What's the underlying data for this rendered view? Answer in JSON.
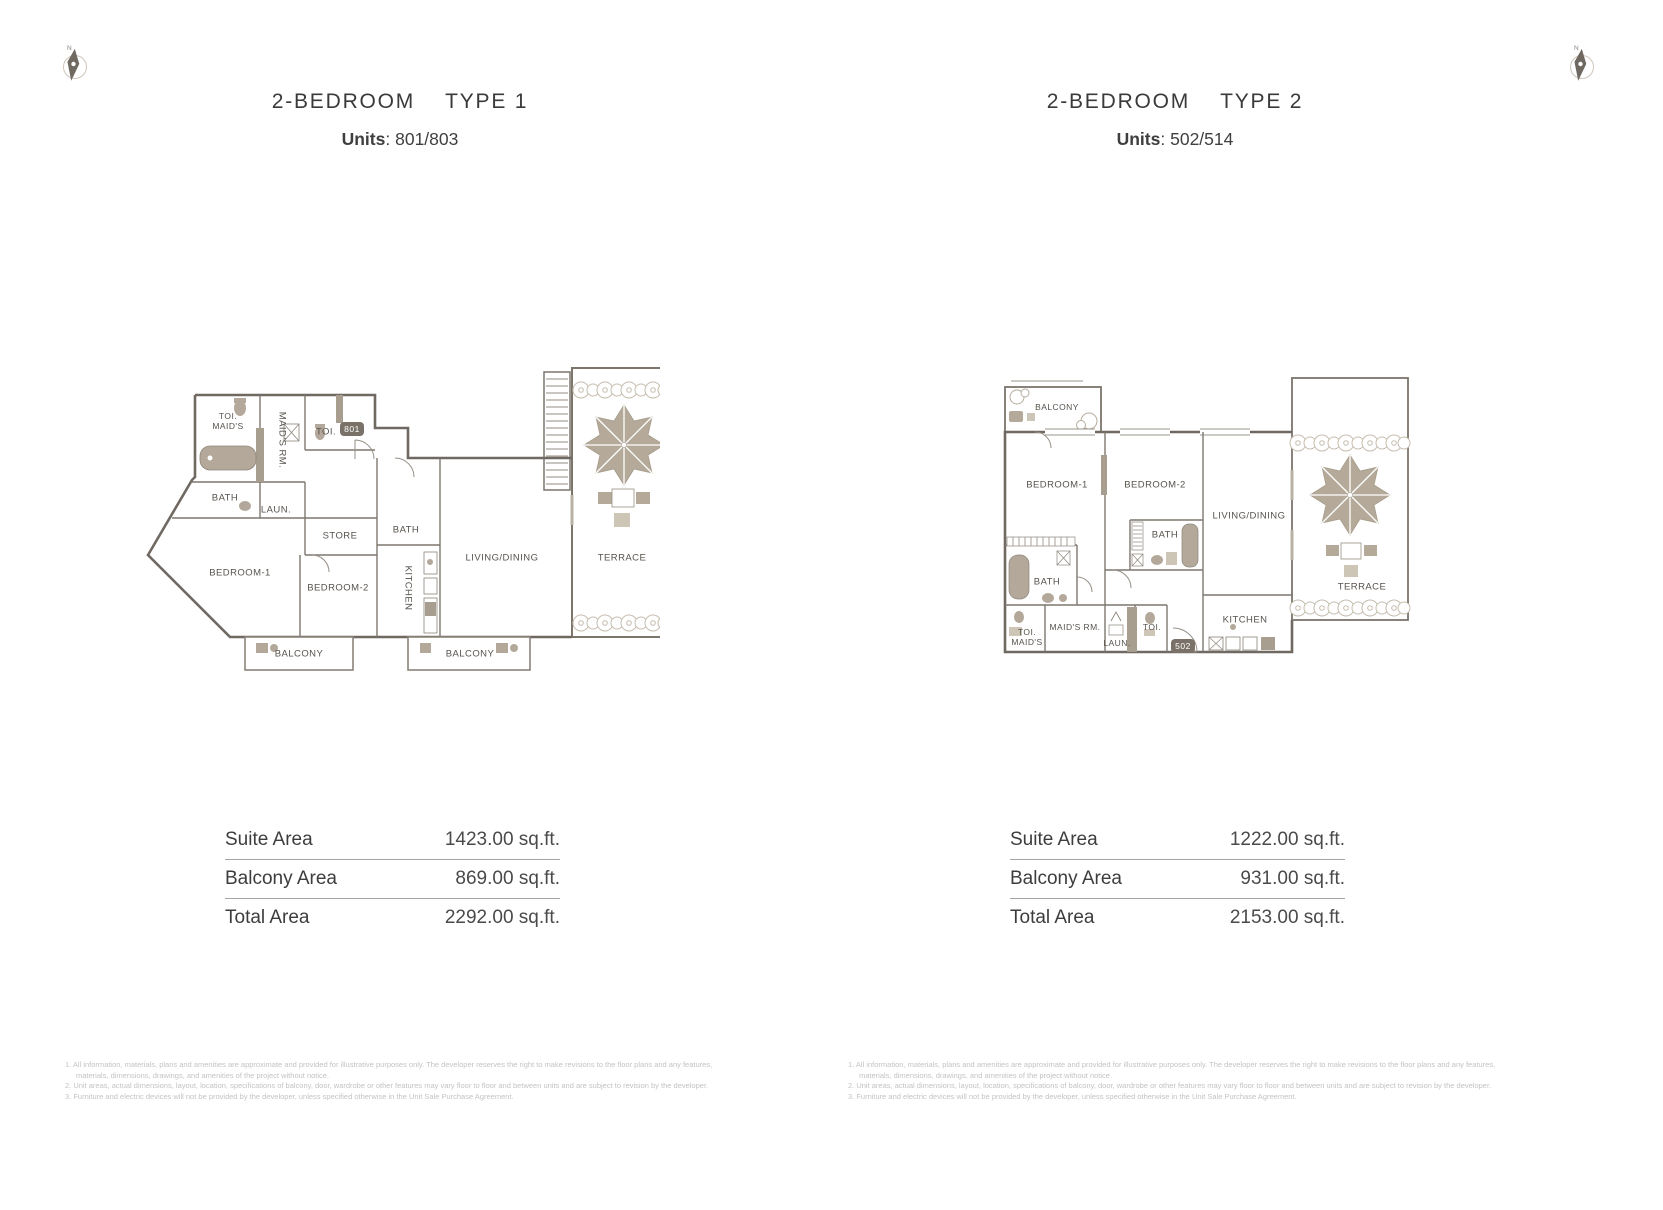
{
  "compass": {
    "north": "N"
  },
  "plan1": {
    "title": "2-BEDROOM",
    "type": "TYPE 1",
    "units_label": "Units",
    "units_sep": ":",
    "units_value": "801/803",
    "badge": "801",
    "rooms": {
      "maids_toi_1": "TOI.",
      "maids_toi_2": "MAID'S",
      "maids_rm": "MAID'S RM.",
      "toi": "TOI.",
      "bath_a": "BATH",
      "laun": "LAUN.",
      "store": "STORE",
      "bath_b": "BATH",
      "kitchen": "KITCHEN",
      "bedroom1": "BEDROOM-1",
      "bedroom2": "BEDROOM-2",
      "living": "LIVING/DINING",
      "terrace": "TERRACE",
      "balcony_a": "BALCONY",
      "balcony_b": "BALCONY"
    },
    "areas": {
      "rows": [
        {
          "label": "Suite Area",
          "value": "1423.00 sq.ft."
        },
        {
          "label": "Balcony Area",
          "value": "869.00 sq.ft."
        },
        {
          "label": "Total Area",
          "value": "2292.00 sq.ft."
        }
      ]
    }
  },
  "plan2": {
    "title": "2-BEDROOM",
    "type": "TYPE 2",
    "units_label": "Units",
    "units_sep": ":",
    "units_value": "502/514",
    "badge": "502",
    "rooms": {
      "balcony": "BALCONY",
      "bedroom1": "BEDROOM-1",
      "bedroom2": "BEDROOM-2",
      "bath_a": "BATH",
      "bath_b": "BATH",
      "maids_toi_1": "TOI.",
      "maids_toi_2": "MAID'S",
      "maids_rm": "MAID'S RM.",
      "laun": "LAUN.",
      "toi": "TOI.",
      "kitchen": "KITCHEN",
      "living": "LIVING/DINING",
      "terrace": "TERRACE"
    },
    "areas": {
      "rows": [
        {
          "label": "Suite Area",
          "value": "1222.00 sq.ft."
        },
        {
          "label": "Balcony Area",
          "value": "931.00 sq.ft."
        },
        {
          "label": "Total Area",
          "value": "2153.00 sq.ft."
        }
      ]
    }
  },
  "disclaimer": [
    "1. All information, materials, plans and amenities are approximate and provided for illustrative purposes only. The developer reserves the right to make revisions to the floor plans and any features, materials, dimensions, drawings, and amenities of the project without notice.",
    "2. Unit areas, actual dimensions, layout, location, specifications of balcony, door, wardrobe or other features may vary floor to floor and between units and are subject to revision by the developer.",
    "3. Furniture and electric devices will not be provided by the developer, unless specified otherwise in the Unit Sale Purchase Agreement."
  ]
}
